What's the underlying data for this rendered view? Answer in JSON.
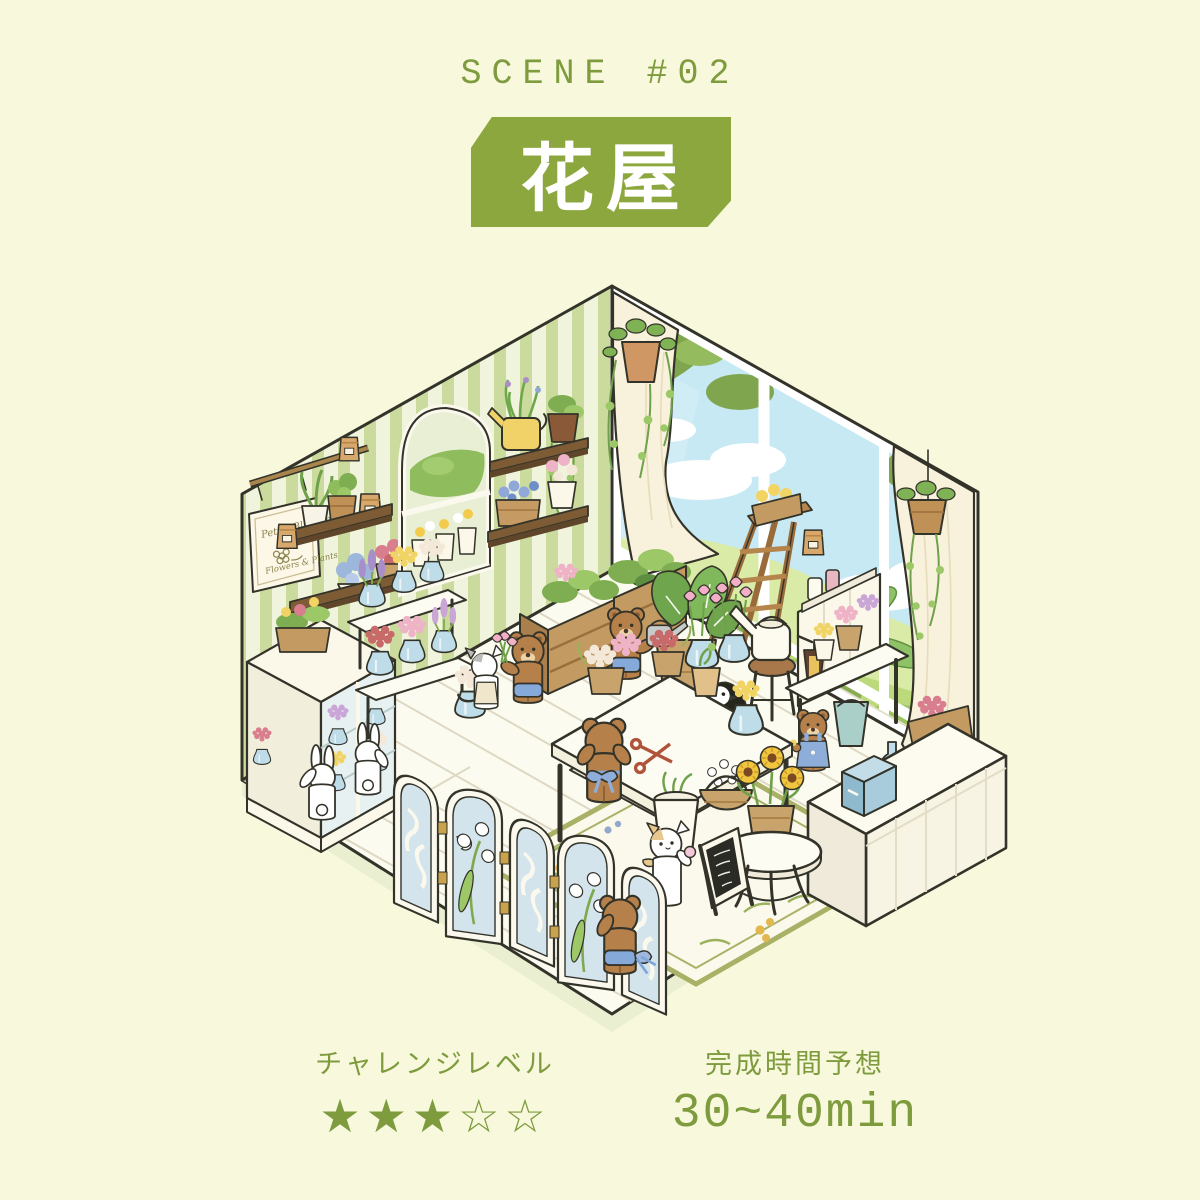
{
  "header": {
    "scene_label": "SCENE #02",
    "title": "花屋"
  },
  "footer": {
    "challenge_label": "チャレンジレベル",
    "stars": "★★★☆☆",
    "stars_filled": 3,
    "stars_total": 5,
    "time_label": "完成時間予想",
    "time_value": "30~40min"
  },
  "scene": {
    "sign_line1": "Petite Blossoms",
    "sign_line2": "Flowers & Plants"
  },
  "colors": {
    "background": "#F8F8DC",
    "banner_green": "#8CA73E",
    "accent_text": "#7E9B3E",
    "wall_stripe": "#CBDB9D",
    "window_sky": "#C6E9F4"
  }
}
